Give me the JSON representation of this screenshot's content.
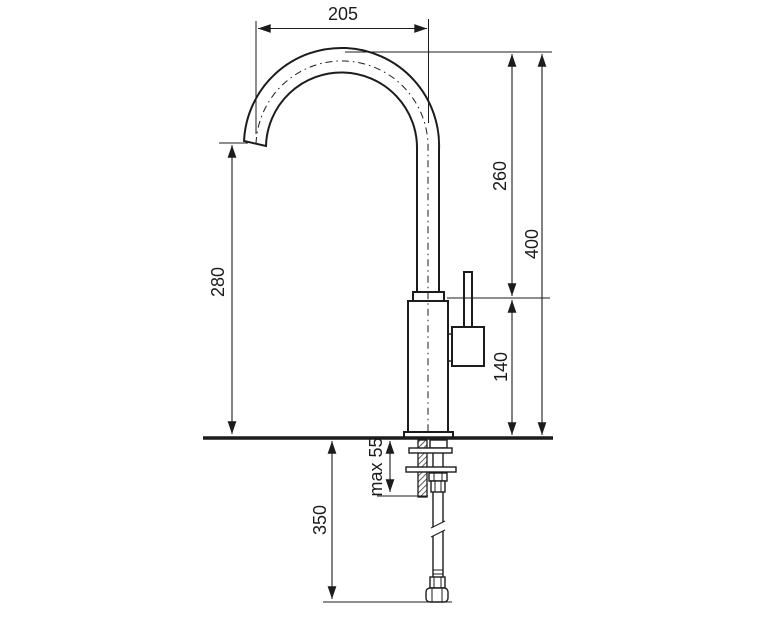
{
  "drawing": {
    "labels": {
      "spout_reach": "205",
      "spout_height": "260",
      "total_height": "400",
      "outlet_height": "280",
      "body_height": "140",
      "max_counter_thickness": "max 55",
      "hose_length": "350"
    },
    "colors": {
      "line": "#1c1c1c",
      "background": "#ffffff"
    }
  }
}
